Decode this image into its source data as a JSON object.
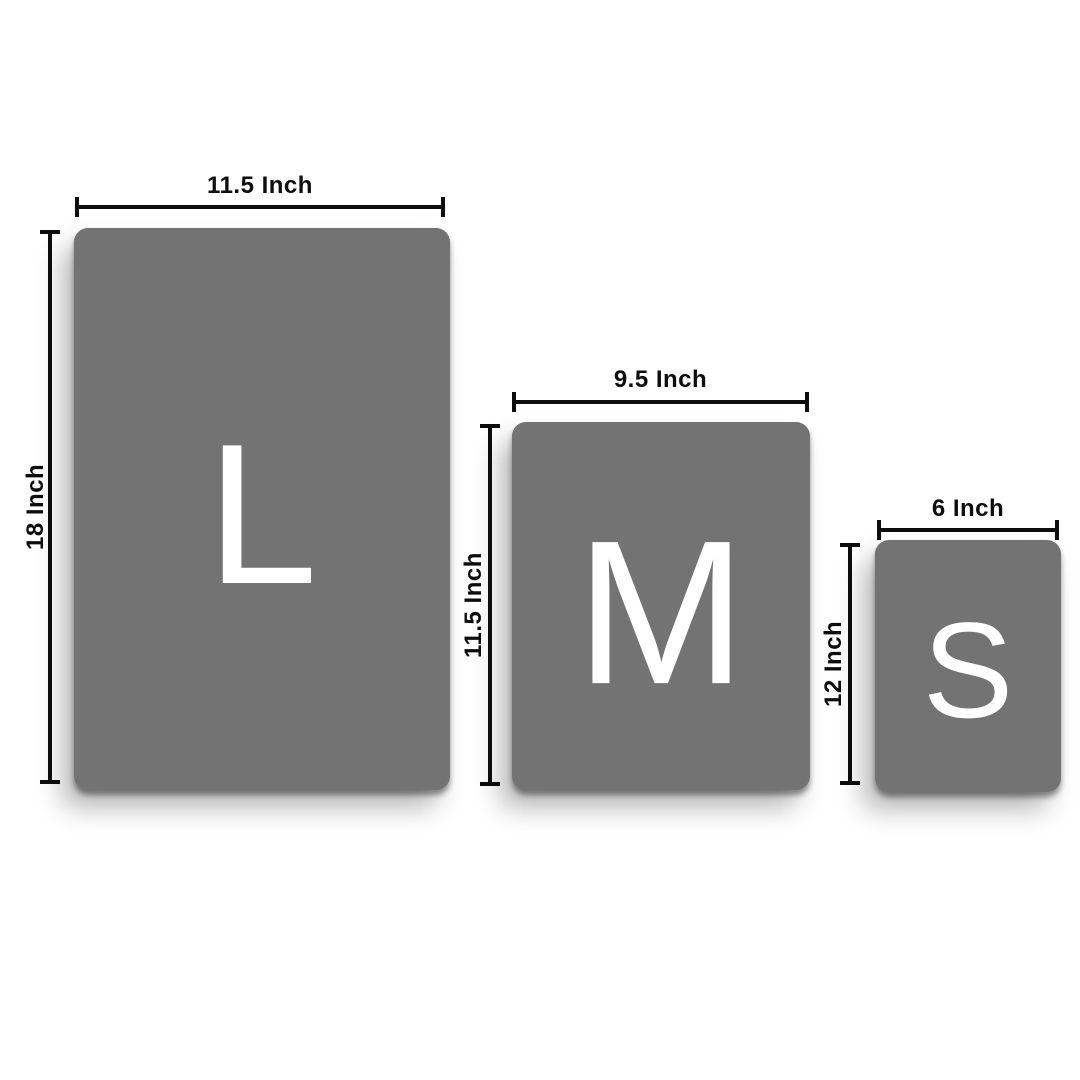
{
  "colors": {
    "background": "#ffffff",
    "box_fill": "#737373",
    "dimension_line": "#0d0d0d",
    "letter": "#ffffff"
  },
  "panels": [
    {
      "size_name": "large",
      "letter": "L",
      "width_label": "11.5 Inch",
      "height_label": "18 Inch"
    },
    {
      "size_name": "medium",
      "letter": "M",
      "width_label": "9.5 Inch",
      "height_label": "11.5 Inch"
    },
    {
      "size_name": "small",
      "letter": "S",
      "width_label": "6 Inch",
      "height_label": "12 Inch"
    }
  ]
}
